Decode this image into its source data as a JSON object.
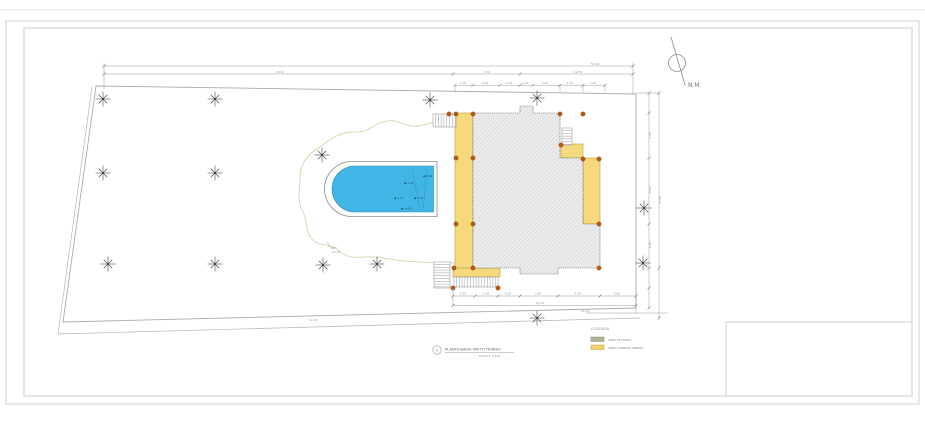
{
  "north": {
    "label": "N.M."
  },
  "title_block": {
    "number": "1",
    "title": "PLANTA BAIXA PAVTO TÉRREO",
    "scale": "ESCALA 1/100"
  },
  "legend": {
    "title": "LEGENDA",
    "items": [
      {
        "label": "AREA FECHADA",
        "color": "#b2b294"
      },
      {
        "label": "AREA COBERTA ABERTA",
        "color": "#f0d36b"
      }
    ]
  },
  "colors": {
    "pool_water": "#41b6e6",
    "pool_edge": "#2f89b5",
    "covered_yellow": "#f6d97c",
    "yellow_edge": "#bfa23f",
    "hatch_line": "#bdbdbd",
    "hatch_bg": "#ececec",
    "column_dot": "#c05a10",
    "contour_green": "#cdd2a3",
    "boundary_gray": "#ababab",
    "dim_gray": "#9a9a9a"
  },
  "pool": {
    "labels": [
      {
        "x": 407,
        "y": 184.5,
        "t": "-1.40"
      },
      {
        "x": 426,
        "y": 177.5,
        "t": "-0.60"
      },
      {
        "x": 397,
        "y": 199.5,
        "t": "-1.70"
      },
      {
        "x": 417,
        "y": 199.5,
        "t": "-1.60"
      },
      {
        "x": 404,
        "y": 210.0,
        "t": "+0.00"
      }
    ]
  },
  "note": {
    "line1": "NPT",
    "line2": "+0.00"
  },
  "dimensions": {
    "labels": [
      {
        "x": 595,
        "y": 64.8,
        "t": "59.60",
        "r": 0
      },
      {
        "x": 280,
        "y": 72.8,
        "t": "39.10",
        "r": 0
      },
      {
        "x": 487,
        "y": 72.8,
        "t": "7.40",
        "r": 0
      },
      {
        "x": 578,
        "y": 72.8,
        "t": "12.55",
        "r": 0
      },
      {
        "x": 463,
        "y": 83.8,
        "t": "2.00",
        "r": 0
      },
      {
        "x": 485,
        "y": 83.8,
        "t": "3.00",
        "r": 0
      },
      {
        "x": 509,
        "y": 83.8,
        "t": "2.25",
        "r": 0
      },
      {
        "x": 525,
        "y": 83.8,
        "t": "1.45",
        "r": 0
      },
      {
        "x": 545,
        "y": 83.8,
        "t": "3.00",
        "r": 0
      },
      {
        "x": 570,
        "y": 83.8,
        "t": "2.55",
        "r": 0
      },
      {
        "x": 593,
        "y": 83.8,
        "t": "2.45",
        "r": 0
      },
      {
        "x": 651,
        "y": 135,
        "t": "4.50",
        "r": -90
      },
      {
        "x": 651,
        "y": 190,
        "t": "6.60",
        "r": -90
      },
      {
        "x": 651,
        "y": 245,
        "t": "4.40",
        "r": -90
      },
      {
        "x": 661,
        "y": 200,
        "t": "21.80",
        "r": -90
      },
      {
        "x": 463,
        "y": 294.6,
        "t": "2.20",
        "r": 0
      },
      {
        "x": 486,
        "y": 294.6,
        "t": "2.30",
        "r": 0
      },
      {
        "x": 508,
        "y": 294.6,
        "t": "2.20",
        "r": 0
      },
      {
        "x": 538,
        "y": 294.6,
        "t": "3.80",
        "r": 0
      },
      {
        "x": 578,
        "y": 294.6,
        "t": "4.20",
        "r": 0
      },
      {
        "x": 617,
        "y": 294.6,
        "t": "3.60",
        "r": 0
      },
      {
        "x": 540,
        "y": 303.8,
        "t": "18.30",
        "r": 0
      },
      {
        "x": 313,
        "y": 321.0,
        "t": "39.25",
        "r": 0
      },
      {
        "x": 585,
        "y": 312.0,
        "t": "23.28",
        "r": 0
      }
    ]
  },
  "drawing": {
    "trees": [
      [
        103,
        99
      ],
      [
        215,
        99
      ],
      [
        430,
        100
      ],
      [
        537,
        98
      ],
      [
        103,
        173
      ],
      [
        215,
        173
      ],
      [
        322,
        155
      ],
      [
        108,
        264
      ],
      [
        215,
        264
      ],
      [
        323,
        265
      ],
      [
        377,
        264
      ],
      [
        644,
        208
      ],
      [
        643,
        263
      ],
      [
        537,
        318
      ]
    ],
    "columns": [
      [
        449,
        114
      ],
      [
        456,
        114
      ],
      [
        473,
        114
      ],
      [
        560,
        114
      ],
      [
        583,
        114
      ],
      [
        561,
        145
      ],
      [
        583,
        159
      ],
      [
        599,
        159
      ],
      [
        456,
        158
      ],
      [
        473,
        158
      ],
      [
        456,
        224
      ],
      [
        473,
        224
      ],
      [
        599,
        224
      ],
      [
        454,
        268
      ],
      [
        473,
        268
      ],
      [
        599,
        268
      ],
      [
        453,
        288
      ],
      [
        498,
        288
      ]
    ],
    "dim_lines": [
      {
        "x1": 104,
        "y1": 66,
        "x2": 633,
        "y2": 66
      },
      {
        "x1": 104,
        "y1": 74,
        "x2": 633,
        "y2": 74
      },
      {
        "x1": 455,
        "y1": 85.2,
        "x2": 605,
        "y2": 85.2
      },
      {
        "x1": 453,
        "y1": 296,
        "x2": 636,
        "y2": 296
      },
      {
        "x1": 453,
        "y1": 305.5,
        "x2": 636,
        "y2": 305.5
      },
      {
        "x1": 649,
        "y1": 93,
        "x2": 649,
        "y2": 308
      },
      {
        "x1": 659,
        "y1": 93,
        "x2": 659,
        "y2": 318
      },
      {
        "x1": 104,
        "y1": 63,
        "x2": 104,
        "y2": 89
      },
      {
        "x1": 633,
        "y1": 63,
        "x2": 633,
        "y2": 94
      },
      {
        "x1": 455,
        "y1": 85.2,
        "x2": 455,
        "y2": 92
      },
      {
        "x1": 560,
        "y1": 85.2,
        "x2": 560,
        "y2": 92
      },
      {
        "x1": 583,
        "y1": 85.2,
        "x2": 583,
        "y2": 92
      },
      {
        "x1": 605,
        "y1": 85.2,
        "x2": 605,
        "y2": 92
      },
      {
        "x1": 453,
        "y1": 288,
        "x2": 453,
        "y2": 306
      },
      {
        "x1": 636,
        "y1": 296,
        "x2": 636,
        "y2": 313
      },
      {
        "x1": 586,
        "y1": 313,
        "x2": 668,
        "y2": 313
      },
      {
        "x1": 636,
        "y1": 93,
        "x2": 660,
        "y2": 93
      }
    ],
    "dim_ticks_h": [
      {
        "y": 66,
        "xs": [
          104,
          633
        ]
      },
      {
        "y": 74,
        "xs": [
          104,
          453,
          520,
          633
        ]
      },
      {
        "y": 85.2,
        "xs": [
          455,
          473,
          500,
          520,
          533,
          560,
          583,
          605
        ]
      },
      {
        "y": 296,
        "xs": [
          453,
          475,
          498,
          520,
          558,
          600,
          636
        ]
      },
      {
        "y": 305.5,
        "xs": [
          453,
          636
        ]
      }
    ],
    "dim_ticks_v": [
      {
        "x": 649,
        "ys": [
          93,
          113,
          158,
          224,
          268,
          288,
          308
        ]
      },
      {
        "x": 659,
        "ys": [
          93,
          268,
          318
        ]
      }
    ]
  }
}
